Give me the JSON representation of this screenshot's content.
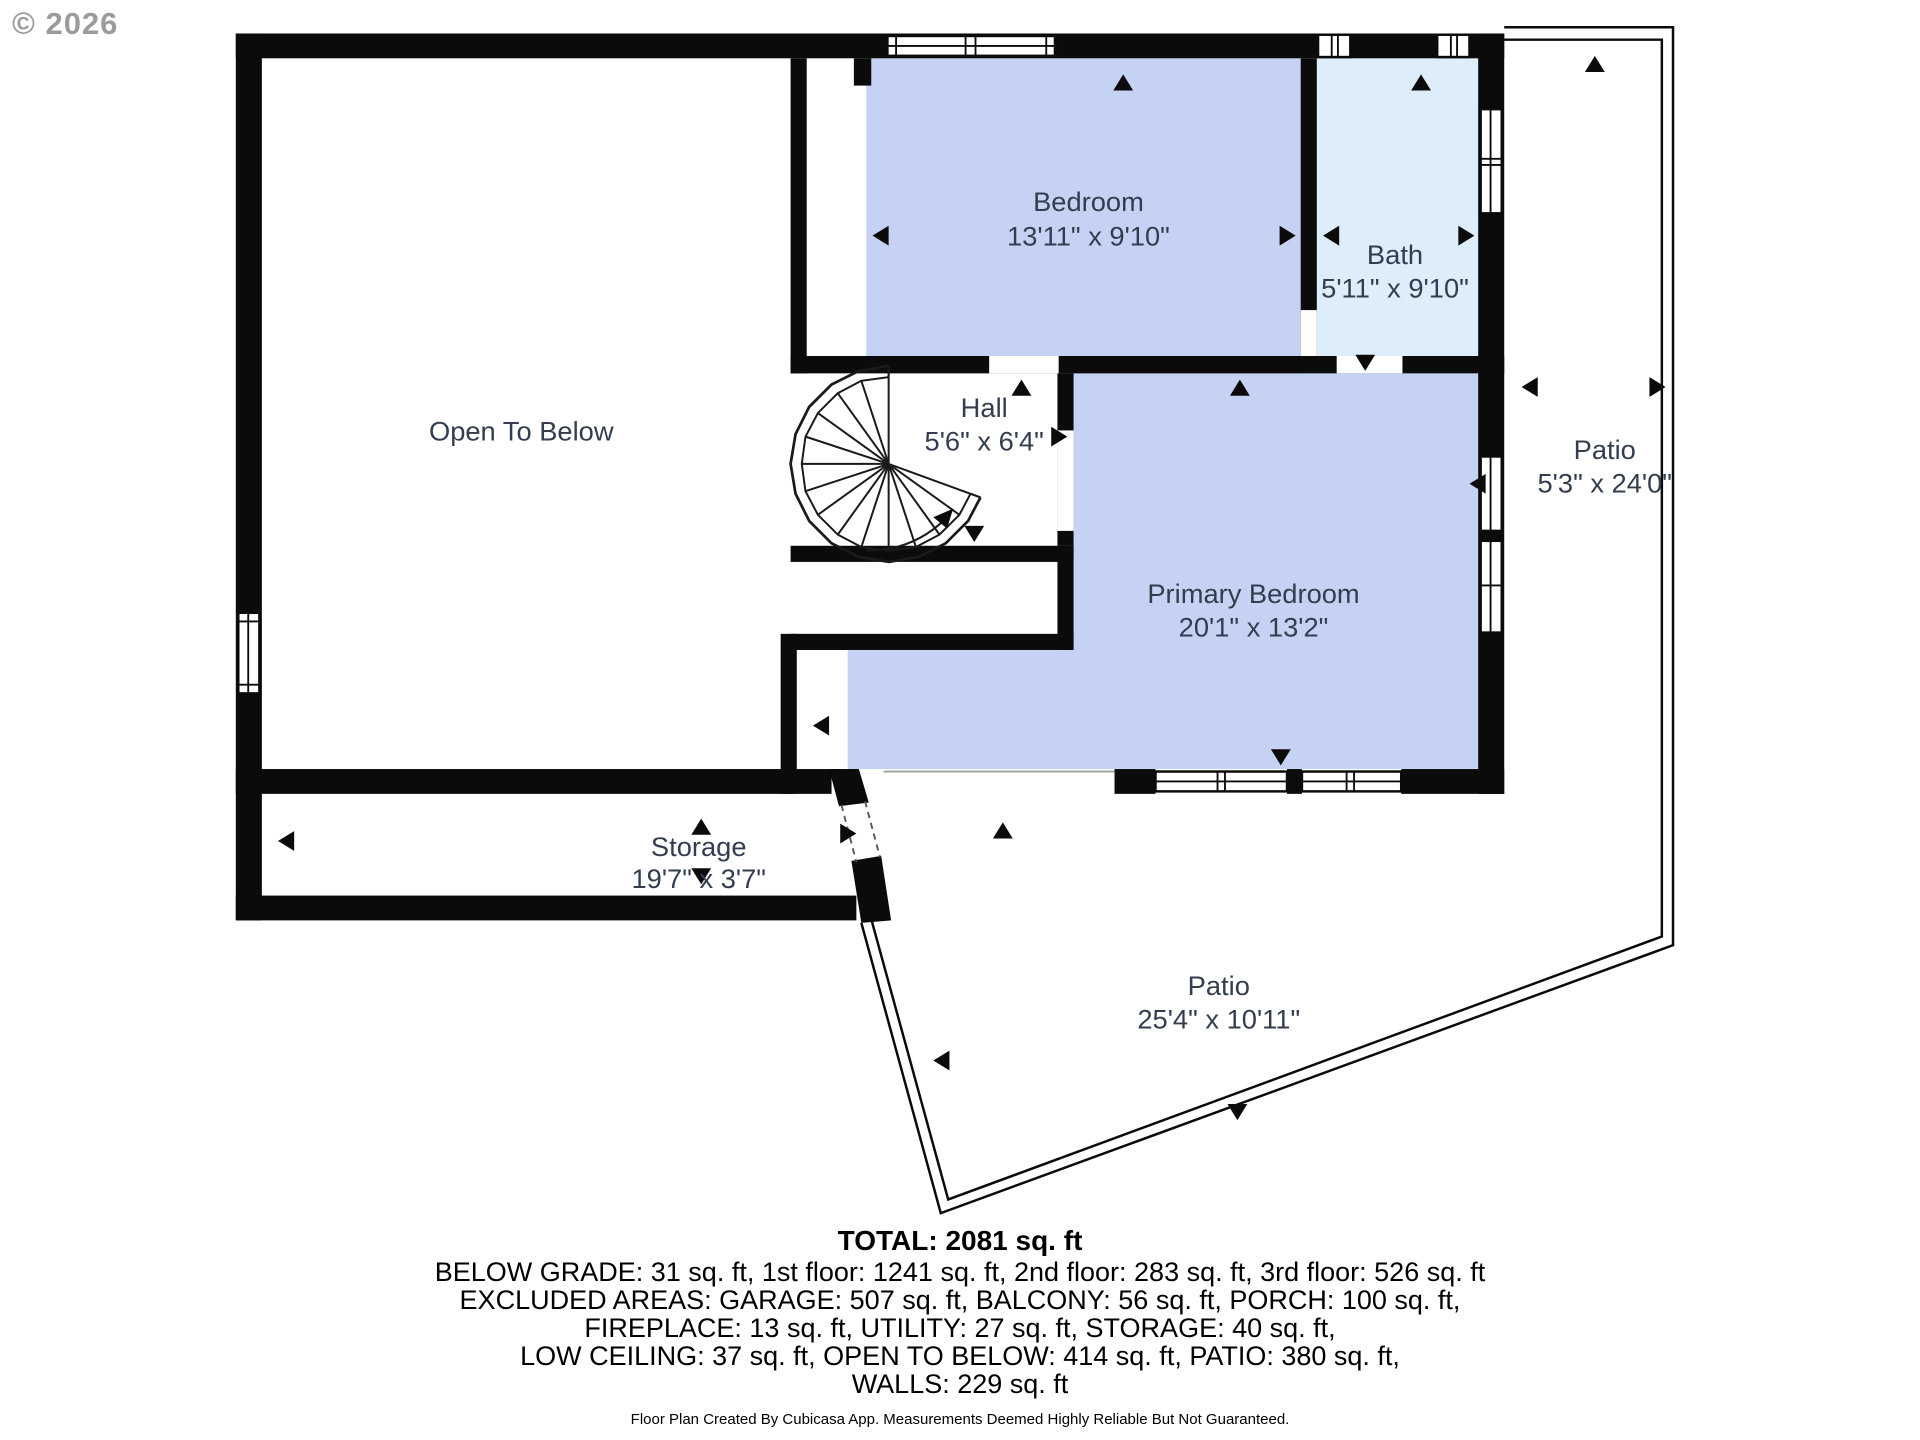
{
  "copyright": "© 2026",
  "colors": {
    "wall": "#0b0b0b",
    "bedroom_fill": "#c5d2f4",
    "bath_fill": "#ddedfa",
    "room_label": "#333d4f",
    "copyright_gray": "#9b9b9b"
  },
  "rooms": {
    "open_to_below": {
      "name": "Open To Below",
      "dims": ""
    },
    "bedroom": {
      "name": "Bedroom",
      "dims": "13'11\" x 9'10\""
    },
    "bath": {
      "name": "Bath",
      "dims": "5'11\" x 9'10\""
    },
    "hall": {
      "name": "Hall",
      "dims": "5'6\" x 6'4\""
    },
    "primary_bedroom": {
      "name": "Primary Bedroom",
      "dims": "20'1\" x 13'2\""
    },
    "patio_right": {
      "name": "Patio",
      "dims": "5'3\" x 24'0\""
    },
    "storage": {
      "name": "Storage",
      "dims": "19'7\" x 3'7\""
    },
    "patio_bottom": {
      "name": "Patio",
      "dims": "25'4\" x 10'11\""
    }
  },
  "summary": {
    "total": "TOTAL: 2081 sq. ft",
    "line1": "BELOW GRADE: 31 sq. ft, 1st floor: 1241 sq. ft, 2nd floor: 283 sq. ft, 3rd floor: 526 sq. ft",
    "line2": "EXCLUDED AREAS: GARAGE: 507 sq. ft, BALCONY: 56 sq. ft, PORCH: 100 sq. ft,",
    "line3": "FIREPLACE: 13 sq. ft, UTILITY: 27 sq. ft, STORAGE: 40 sq. ft,",
    "line4": "LOW CEILING: 37 sq. ft, OPEN TO BELOW: 414 sq. ft, PATIO: 380 sq. ft,",
    "line5": "WALLS: 229 sq. ft"
  },
  "footer": {
    "disclaimer": "Floor Plan Created By Cubicasa App. Measurements Deemed Highly Reliable But Not Guaranteed."
  }
}
